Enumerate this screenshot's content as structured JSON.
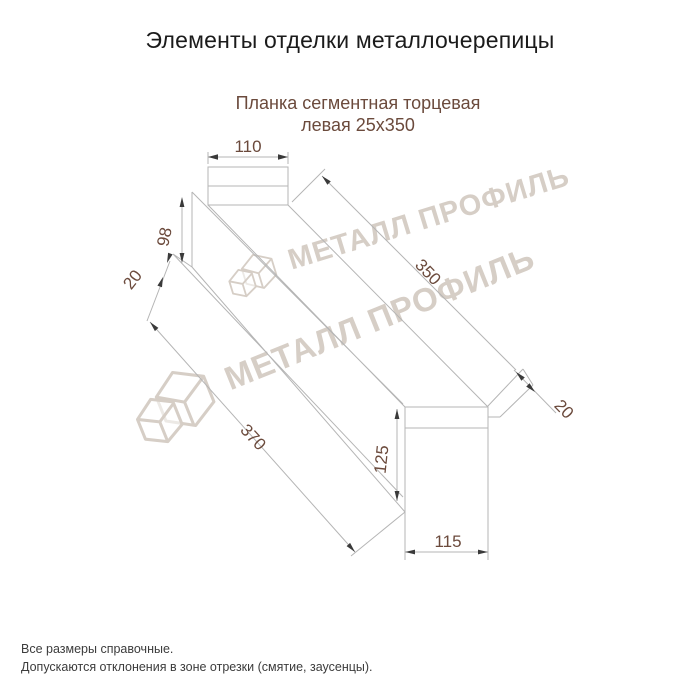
{
  "page": {
    "title": "Элементы отделки металлочерепицы"
  },
  "product": {
    "name": "Планка сегментная торцевая",
    "variant": "левая 25х350"
  },
  "dimensions": {
    "top_face_width": "110",
    "left_end_height": "98",
    "left_hem": "20",
    "top_length": "350",
    "bottom_length": "370",
    "right_end_height": "125",
    "right_end_width": "115",
    "right_hem": "20"
  },
  "watermark": {
    "brand": "МЕТАЛЛ ПРОФИЛЬ"
  },
  "footer": {
    "note1": "Все размеры справочные.",
    "note2": "Допускаются отклонения в зоне отрезки (смятие, заусенцы)."
  },
  "colors": {
    "accent": "#6b4a3c",
    "line": "#b5b5b5",
    "arrow": "#3a3a3a",
    "watermark": "#d6cec6"
  }
}
